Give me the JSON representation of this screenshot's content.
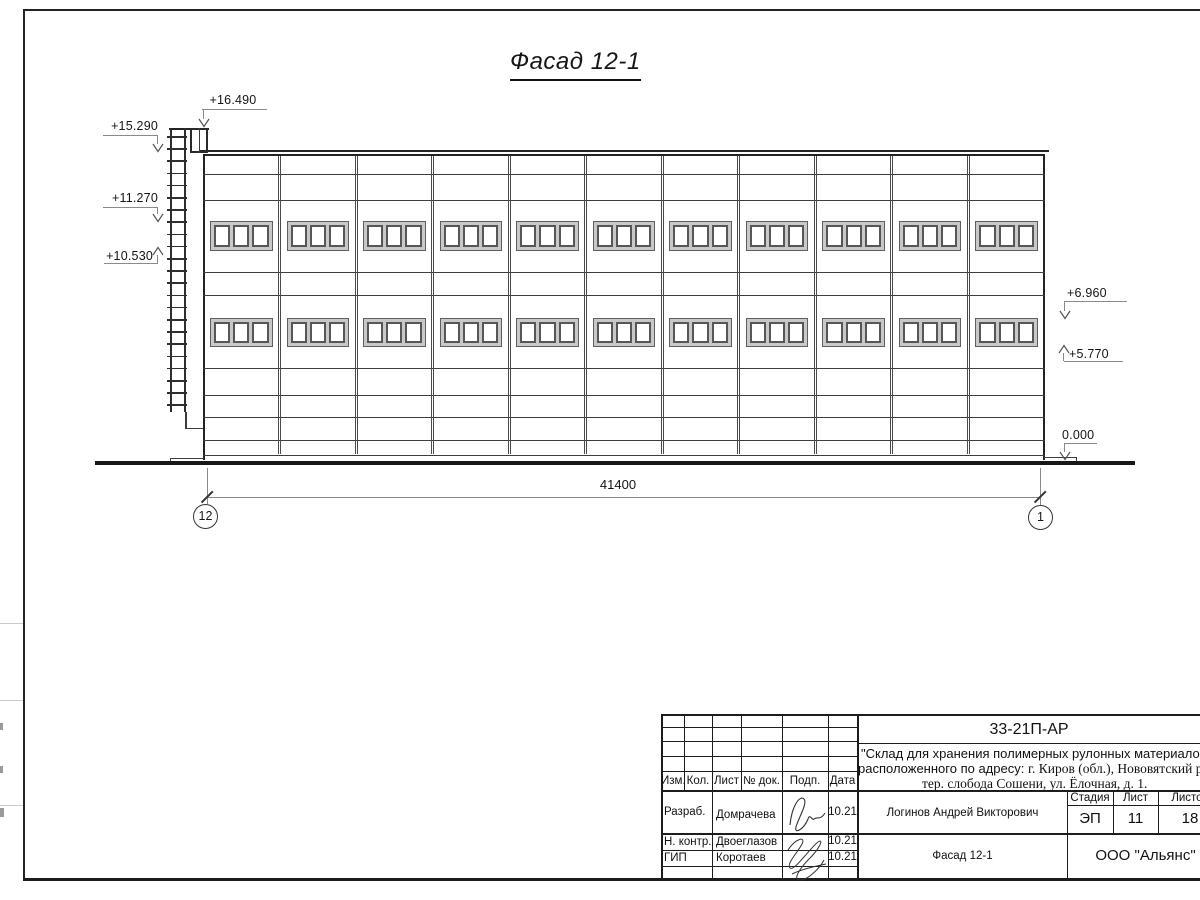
{
  "sheet": {
    "drawing_title": "Фасад 12-1",
    "dimension_total": "41400",
    "axis_left": "12",
    "axis_right": "1",
    "elevation_marks": [
      "+16.490",
      "+15.290",
      "+11.270",
      "+10.530",
      "+6.960",
      "+5.770",
      "0.000"
    ]
  },
  "facade": {
    "bays": 11,
    "window_rows": 2,
    "panes_per_window": 3,
    "ladder_rungs": 23
  },
  "title_block": {
    "doc_number": "33-21П-АР",
    "project_line1": "\"Склад для хранения полимерных рулонных материалов",
    "project_line2_sans": "расположенного по адресу: ",
    "project_line2_serif": "г. Киров (обл.), Нововятский р-н,",
    "project_line3": "тер. слобода Сошени, ул. Ёлочная, д. 1.",
    "header_cols": [
      "Изм.",
      "Кол.",
      "Лист",
      "№ док.",
      "Подп.",
      "Дата"
    ],
    "rows": [
      {
        "role": "Разраб.",
        "name": "Домрачева",
        "date": "10.21"
      },
      {
        "role": "Н. контр.",
        "name": "Двоеглазов",
        "date": "10.21"
      },
      {
        "role": "ГИП",
        "name": "Коротаев",
        "date": "10.21"
      }
    ],
    "approver": "Логинов Андрей Викторович",
    "stage_label": "Стадия",
    "sheet_label": "Лист",
    "sheets_label": "Листов",
    "stage": "ЭП",
    "sheet_no": "11",
    "sheets_total": "18",
    "drawing_name": "Фасад 12-1",
    "company": "ООО \"Альянс\""
  }
}
